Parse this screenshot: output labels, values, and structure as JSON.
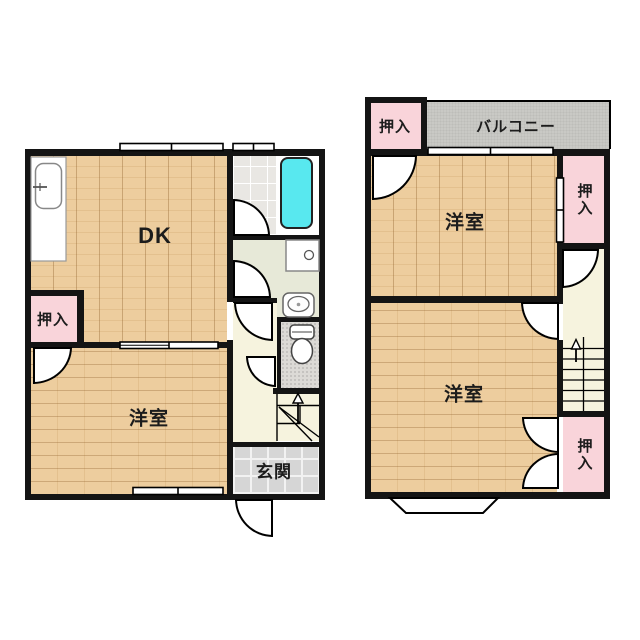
{
  "floorplan": {
    "floor1": {
      "rooms": {
        "dk": {
          "label": "DK"
        },
        "yoshitsu": {
          "label": "洋室"
        },
        "oshiire": {
          "label": "押入"
        },
        "genkan": {
          "label": "玄関"
        }
      },
      "fixtures": [
        "kitchen-sink",
        "bathtub",
        "washing-machine-pan",
        "washbasin",
        "toilet",
        "stairs-up"
      ]
    },
    "floor2": {
      "rooms": {
        "balcony": {
          "label": "バルコニー"
        },
        "oshiire_top_left": {
          "label": "押入"
        },
        "yoshitsu_upper": {
          "label": "洋室"
        },
        "oshiire_upper_right": {
          "label": "押入"
        },
        "yoshitsu_lower": {
          "label": "洋室"
        },
        "oshiire_lower_right": {
          "label": "押入"
        }
      },
      "fixtures": [
        "stairs-up",
        "bay-window"
      ]
    },
    "colors": {
      "wood": "#ecc997",
      "pink": "#f9d4da",
      "balcony": "#c9c9c5",
      "cream": "#f6f3de",
      "tile_gray": "#d6d6d6",
      "bath_tile": "#e9e7e3",
      "washroom_green": "#e7e9d8",
      "toilet_gray": "#dcdad6",
      "tub_cyan": "#58e8ef",
      "wall": "#141414"
    }
  }
}
